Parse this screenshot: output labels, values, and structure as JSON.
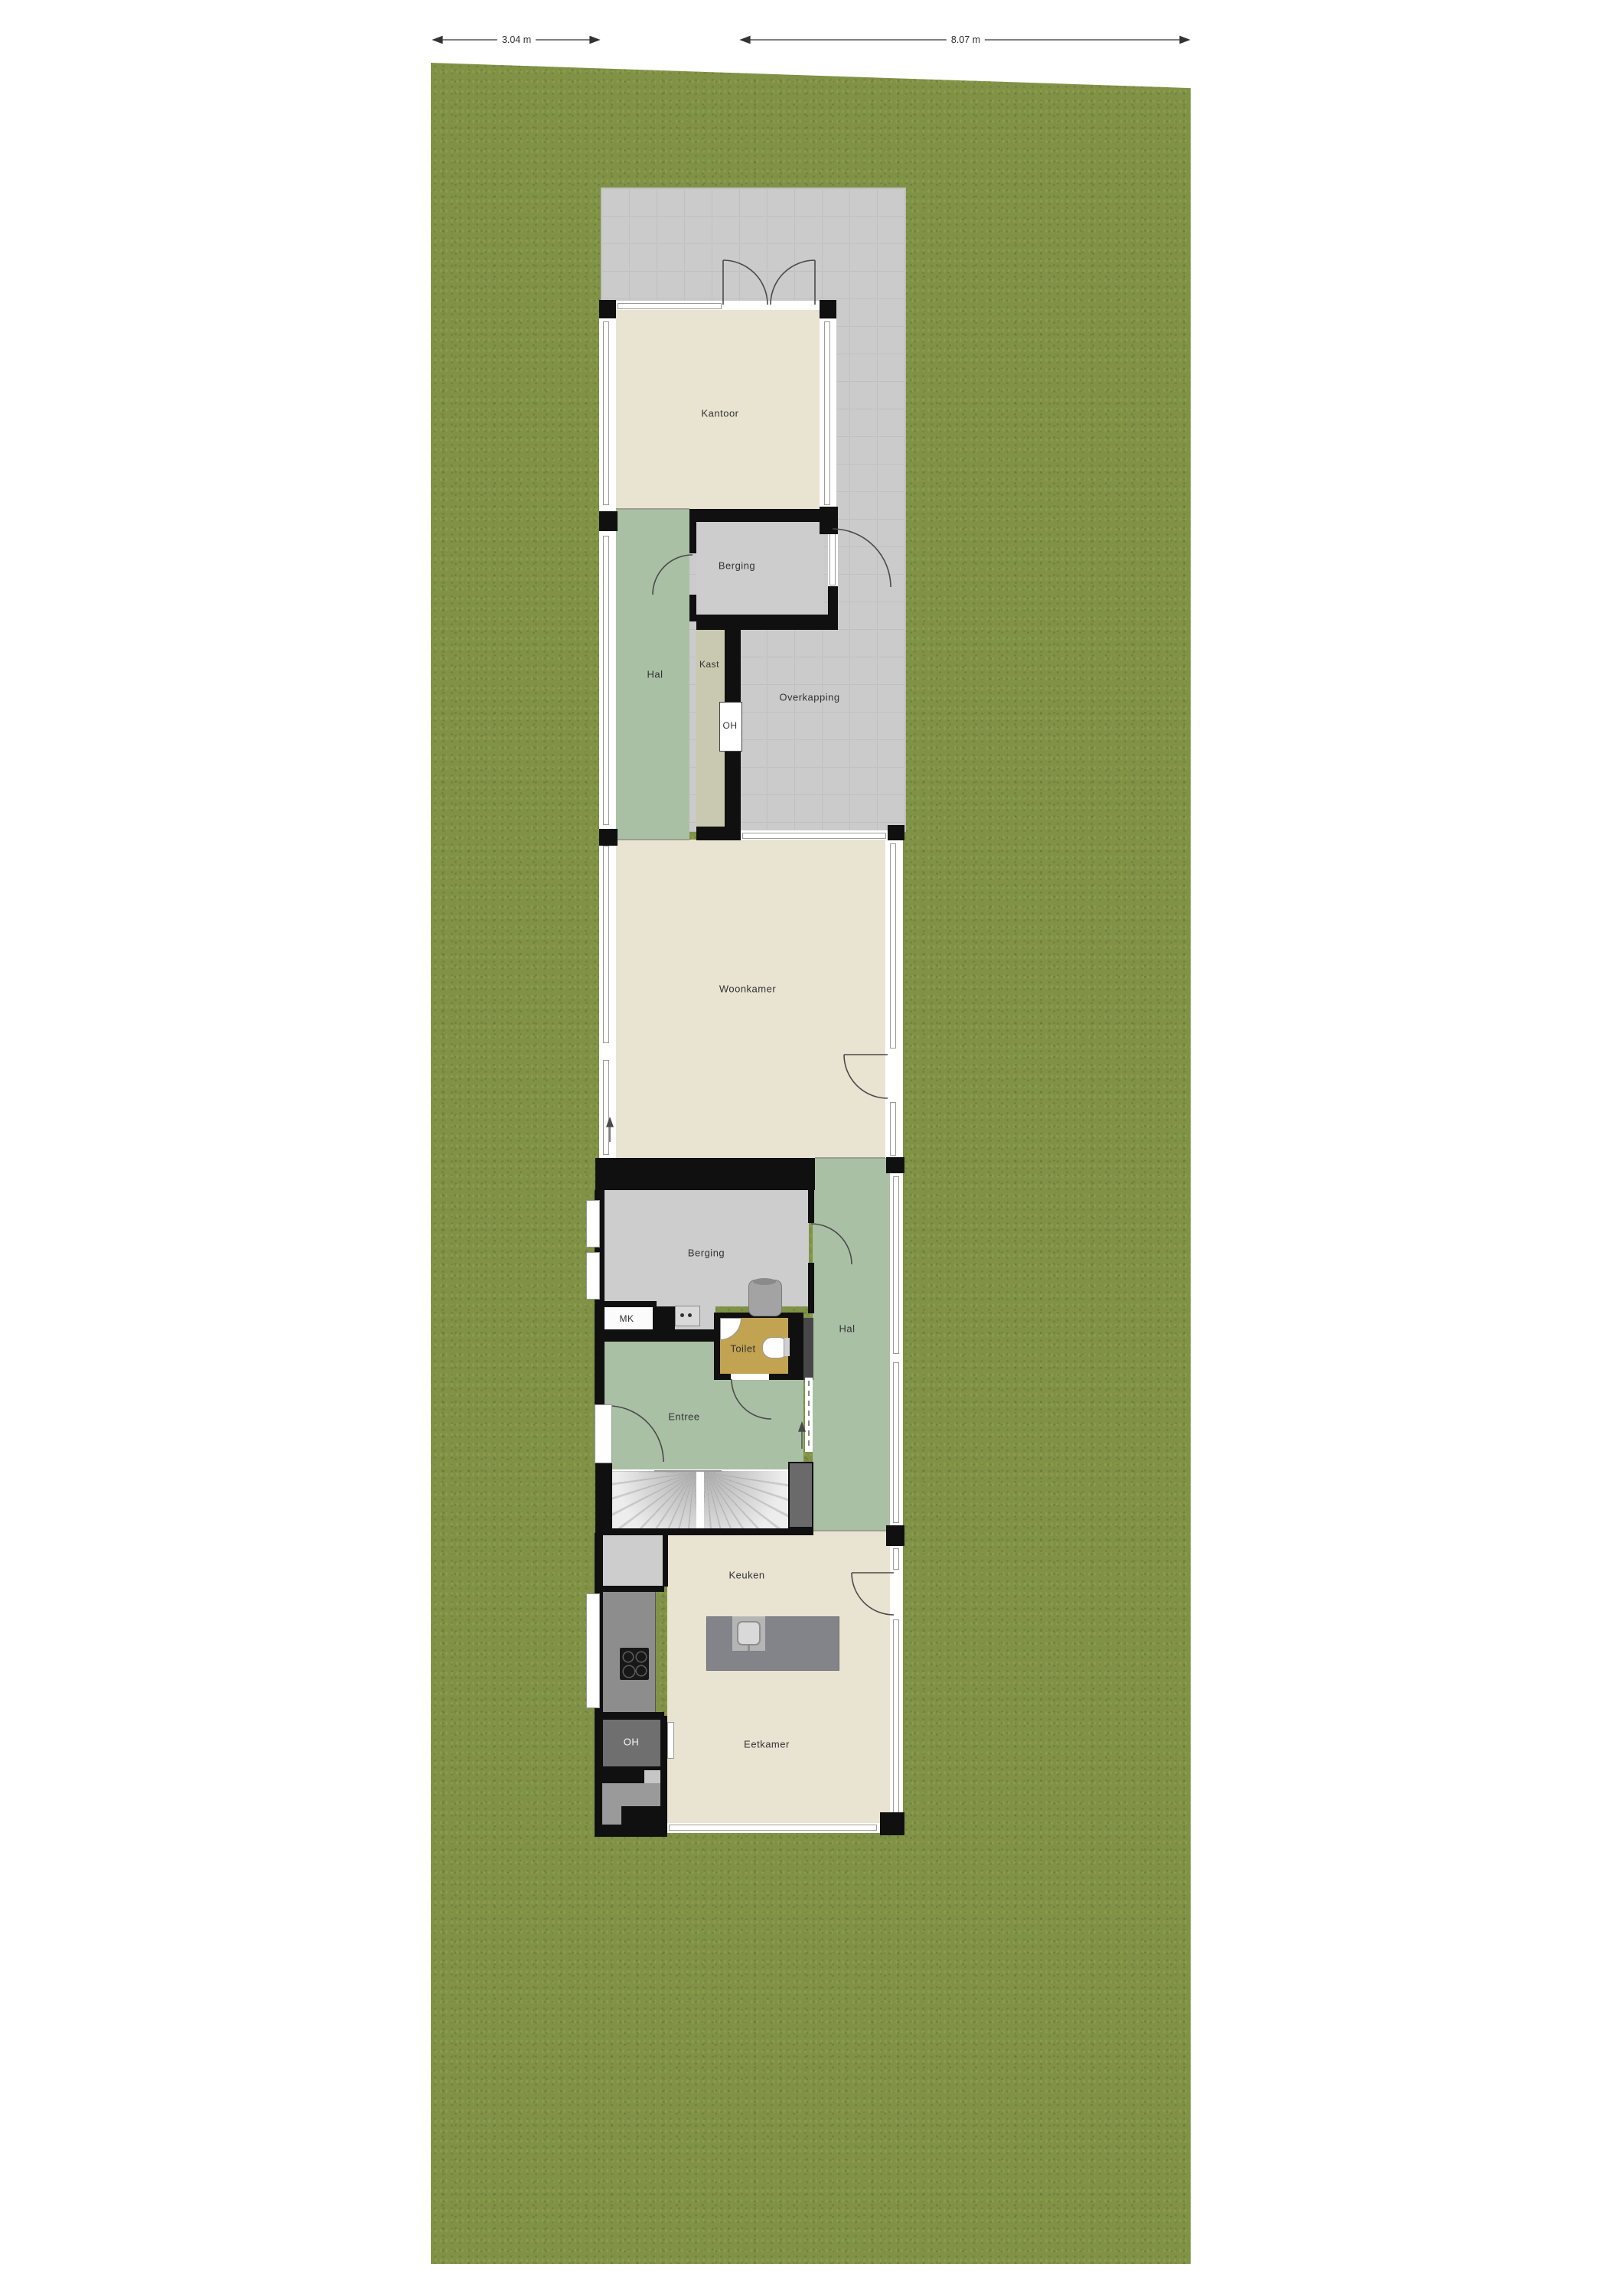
{
  "plan_title": "floor-plan-with-garden-plot",
  "dimensions": {
    "left": "3.04 m",
    "right": "8.07 m"
  },
  "rooms": {
    "kantoor": "Kantoor",
    "berging_top": "Berging",
    "hal_top": "Hal",
    "kast": "Kast",
    "oh_top": "OH",
    "overkapping": "Overkapping",
    "woonkamer": "Woonkamer",
    "berging_mid": "Berging",
    "mk": "MK",
    "toilet": "Toilet",
    "hal_mid": "Hal",
    "entree": "Entree",
    "keuken": "Keuken",
    "oh_bottom": "OH",
    "eetkamer": "Eetkamer"
  },
  "colors": {
    "grass": "#7f9246",
    "paving": "#cbcbcb",
    "floor_beige": "#e9e3d1",
    "floor_green": "#a9c0a5",
    "floor_gray": "#cdcdcd",
    "floor_kast": "#c9c8b1",
    "floor_toilet": "#c2a351",
    "wall": "#101010",
    "counter": "#8d8d8d",
    "island": "#83848a",
    "oh_dark": "#6f6f6f"
  }
}
